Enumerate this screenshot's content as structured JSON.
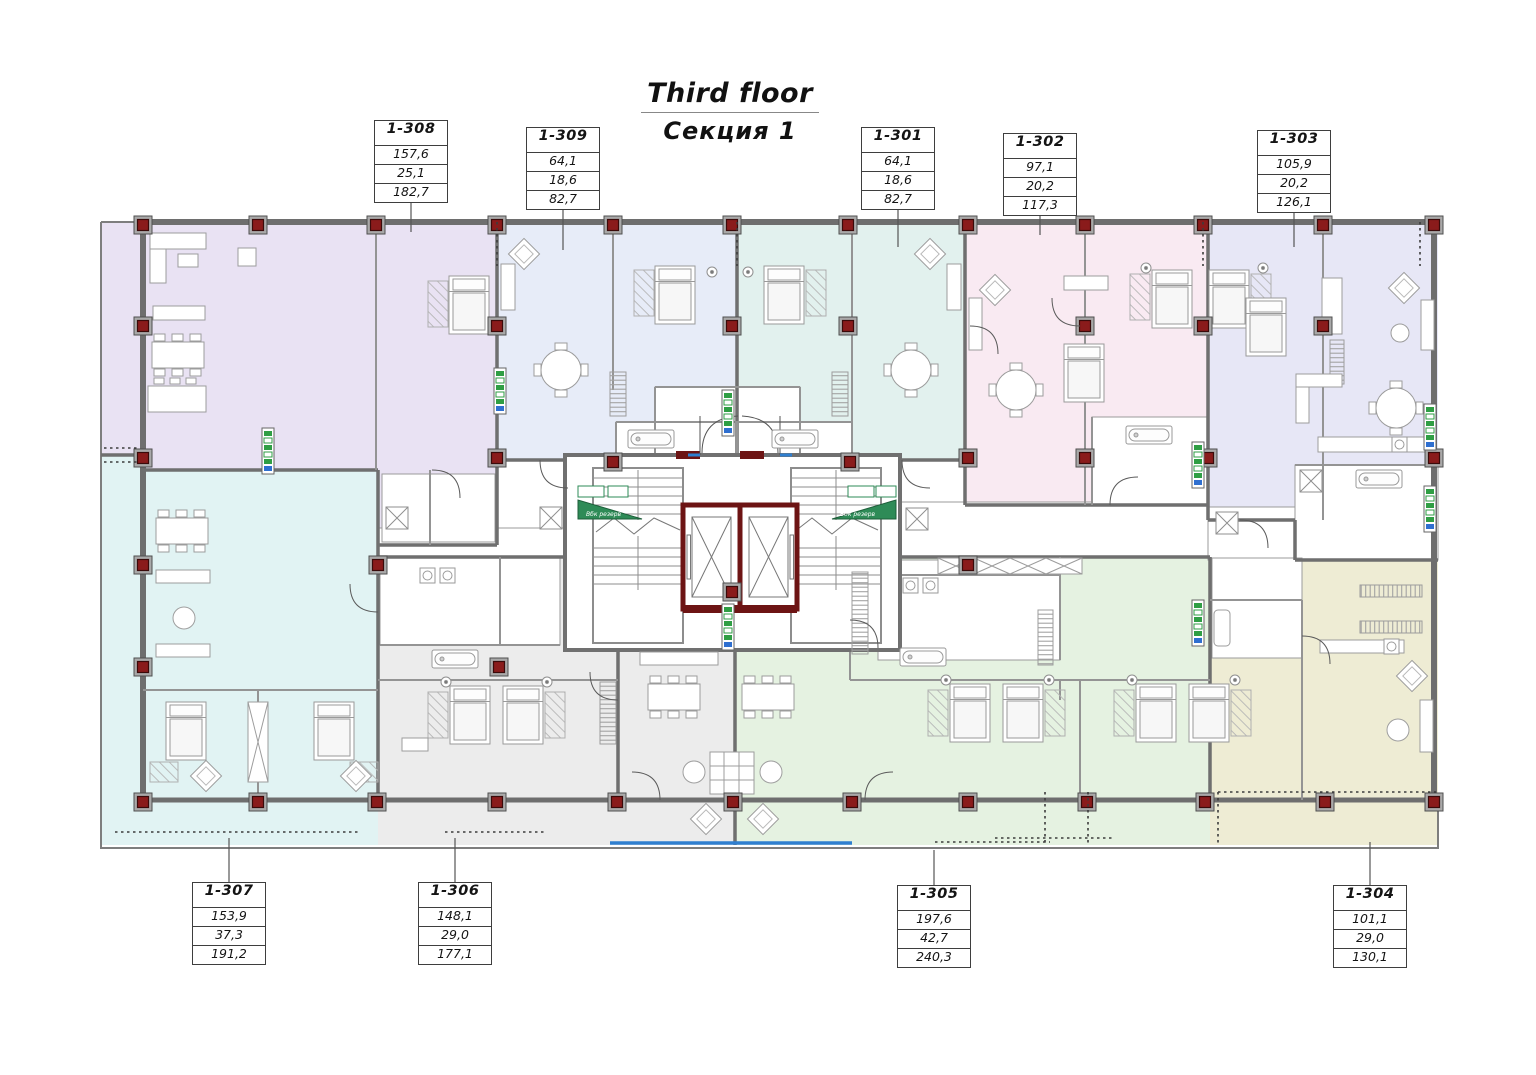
{
  "title": {
    "line1": "Third floor",
    "line2": "Секция 1"
  },
  "core": {
    "reserve_label": "Вбк резерв"
  },
  "colors": {
    "apt_1_308": "#e9e2f3",
    "apt_1_309": "#e7ecf8",
    "apt_1_301": "#e2f1ee",
    "apt_1_302": "#f9eaf2",
    "apt_1_303": "#e7e7f6",
    "apt_1_304": "#eeecd4",
    "apt_1_305": "#e5f2e1",
    "apt_1_306": "#ececec",
    "apt_1_307": "#e1f3f3",
    "column_red": "#8a1b1b",
    "elevator_wall": "#6d1414",
    "glazing_blue": "#2f7fd0",
    "riser_green": "#2f9e44"
  },
  "apartments": [
    {
      "id": "1-308",
      "area_living": "157,6",
      "area_other": "25,1",
      "area_total": "182,7"
    },
    {
      "id": "1-309",
      "area_living": "64,1",
      "area_other": "18,6",
      "area_total": "82,7"
    },
    {
      "id": "1-301",
      "area_living": "64,1",
      "area_other": "18,6",
      "area_total": "82,7"
    },
    {
      "id": "1-302",
      "area_living": "97,1",
      "area_other": "20,2",
      "area_total": "117,3"
    },
    {
      "id": "1-303",
      "area_living": "105,9",
      "area_other": "20,2",
      "area_total": "126,1"
    },
    {
      "id": "1-304",
      "area_living": "101,1",
      "area_other": "29,0",
      "area_total": "130,1"
    },
    {
      "id": "1-305",
      "area_living": "197,6",
      "area_other": "42,7",
      "area_total": "240,3"
    },
    {
      "id": "1-306",
      "area_living": "148,1",
      "area_other": "29,0",
      "area_total": "177,1"
    },
    {
      "id": "1-307",
      "area_living": "153,9",
      "area_other": "37,3",
      "area_total": "191,2"
    }
  ]
}
